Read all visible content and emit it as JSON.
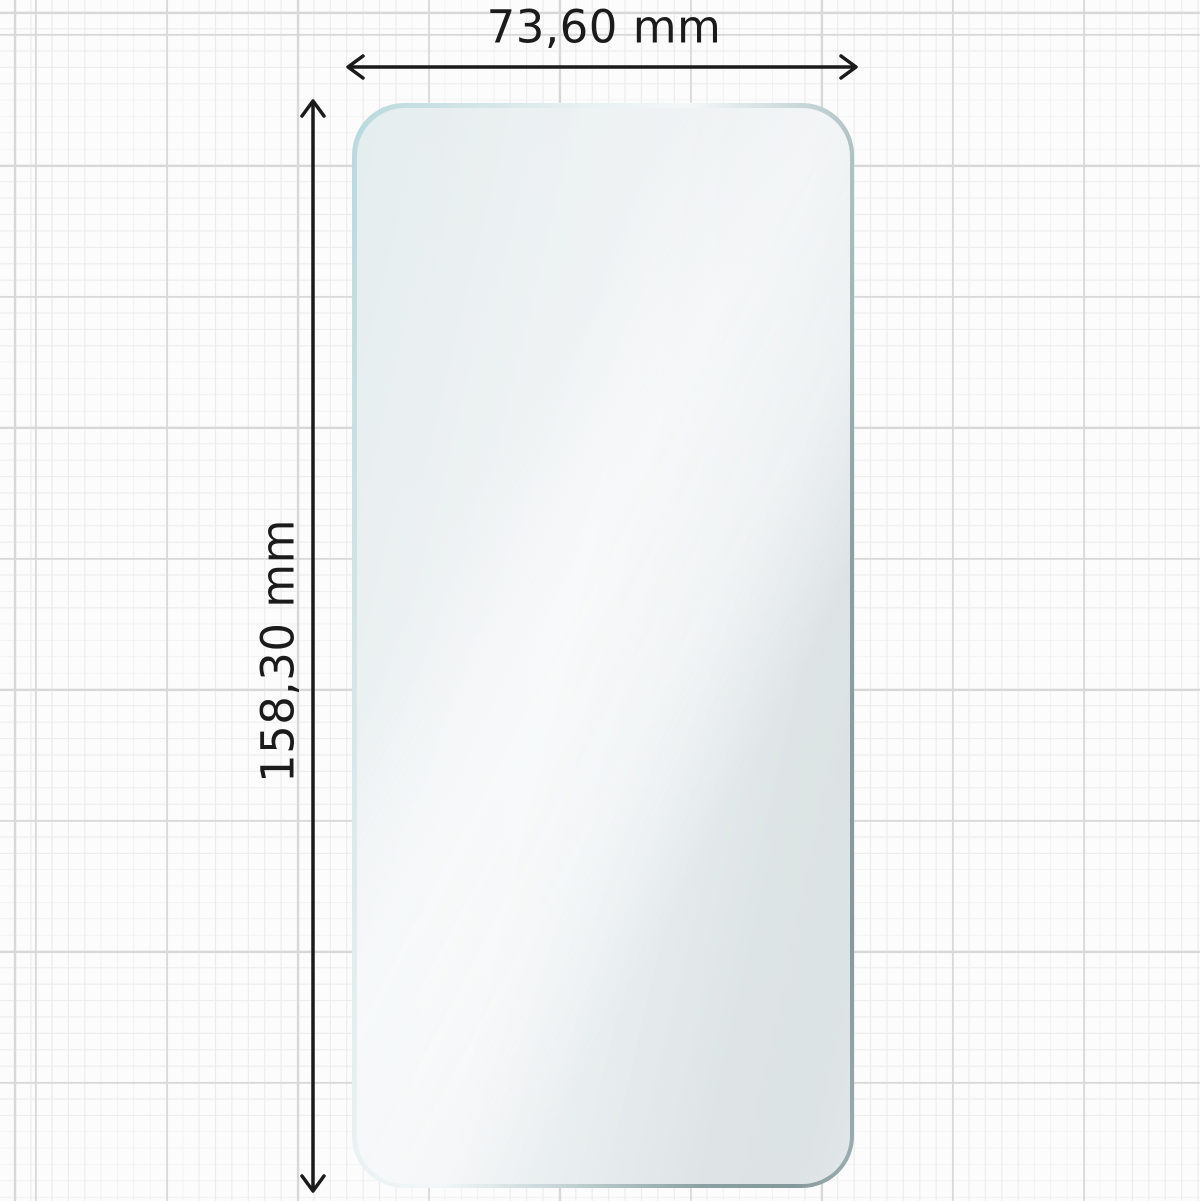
{
  "diagram": {
    "title": "screen protector dimension drawing",
    "object": {
      "shape": "rounded-rectangle screen protector film",
      "fill_color": "#f0f3f4",
      "edge_color_light": "#b7d9dd",
      "edge_color_dark": "#85999c"
    },
    "width_dimension": {
      "label": "73,60 mm",
      "value_mm": 73.6,
      "orientation": "horizontal"
    },
    "height_dimension": {
      "label": "158,30 mm",
      "value_mm": 158.3,
      "orientation": "vertical"
    },
    "background": {
      "style": "graph paper grid",
      "minor_line_color": "#ececec",
      "major_line_color": "#d8d8d8",
      "paper_color": "#fcfcfc"
    },
    "arrow_color": "#1b1b1b"
  }
}
